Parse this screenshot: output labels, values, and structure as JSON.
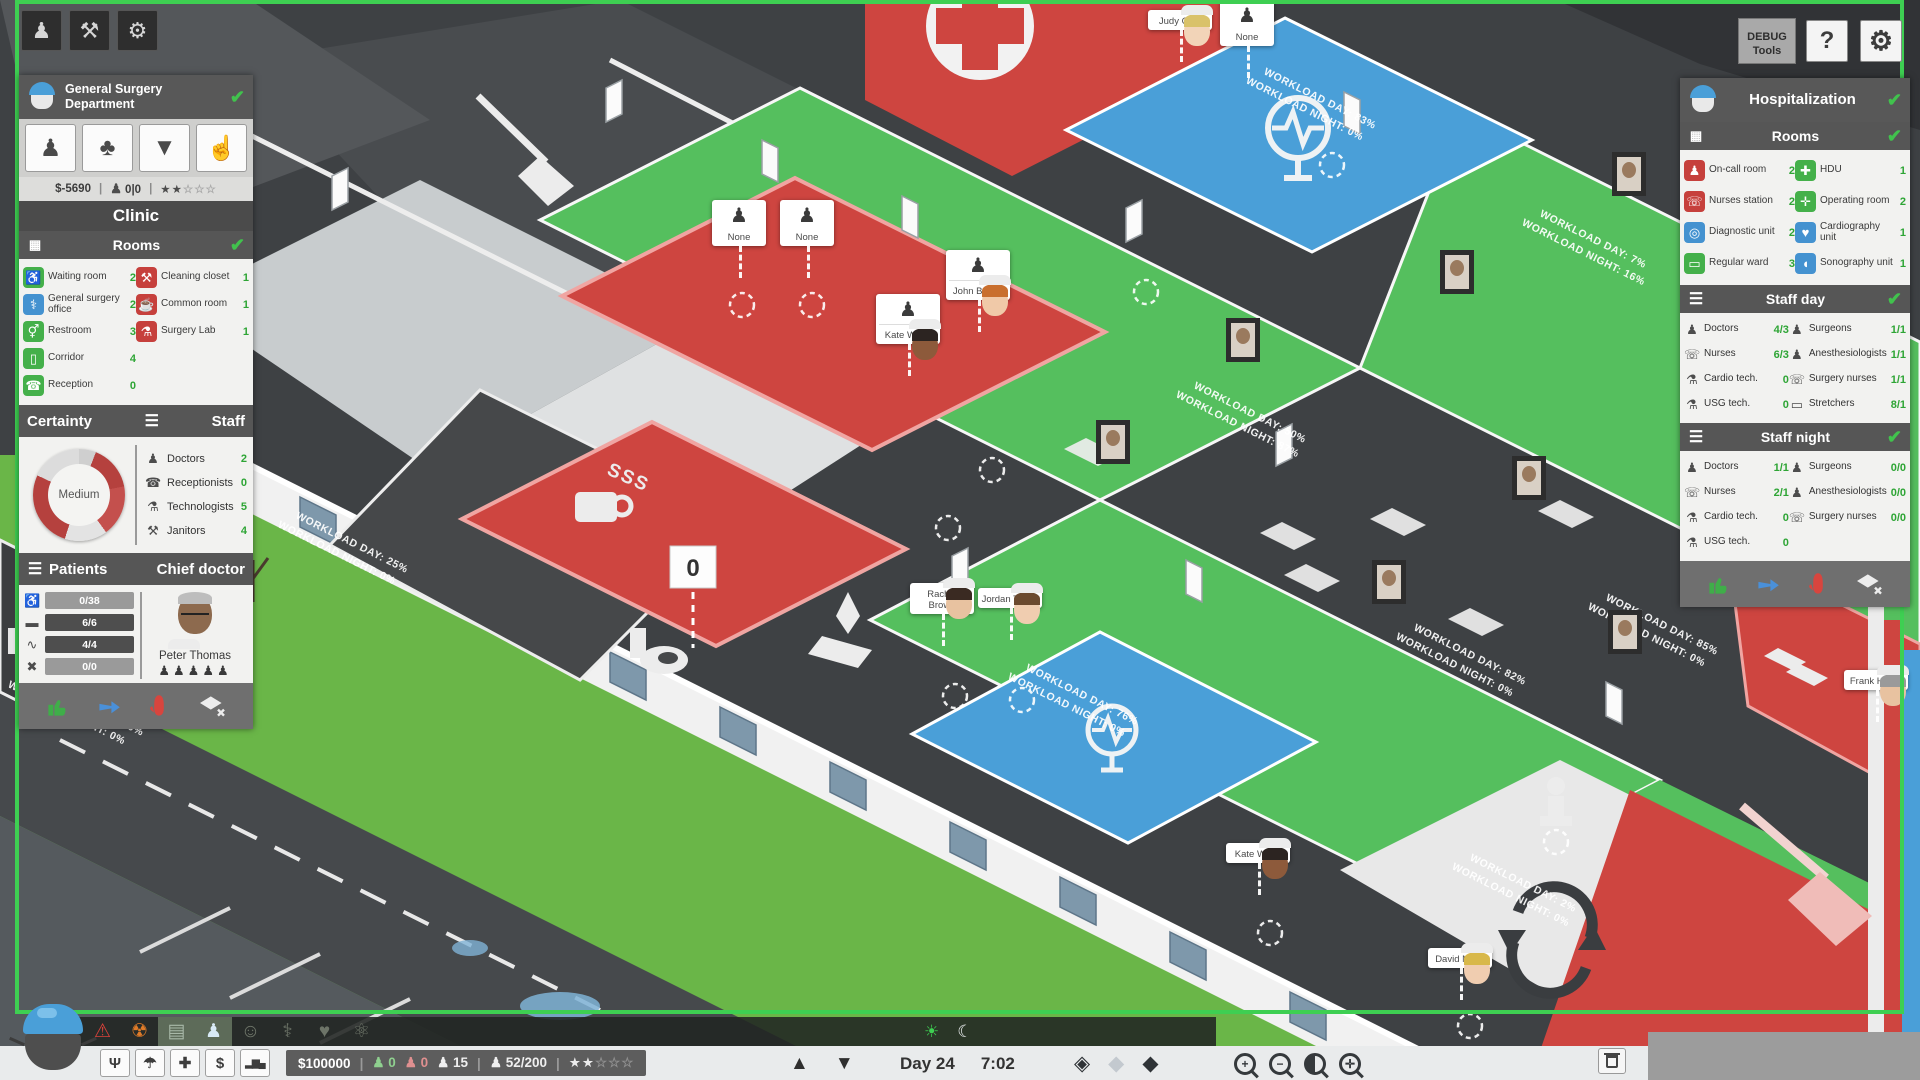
{
  "icon_glyphs": {
    "person": "♟",
    "person-add": "♟",
    "tree": "♣",
    "shirt": "▼",
    "hand": "☝",
    "pickaxe": "⚒",
    "gear": "⚙",
    "list": "☰",
    "rooms": "▦",
    "waiting-room": "♿",
    "cleaning-closet": "⚒",
    "surgery-office": "⚕",
    "common-room": "☕",
    "restroom": "⚥",
    "surgery-lab": "⚗",
    "corridor": "▯",
    "reception": "☎",
    "on-call-room": "♟",
    "hdu": "✚",
    "nurses-station": "☏",
    "operating-room": "✛",
    "diagnostic-unit": "◎",
    "cardiography-unit": "♥",
    "regular-ward": "▭",
    "sonography-unit": "◖",
    "doctor": "♟",
    "receptionist": "☎",
    "technologist": "⚗",
    "janitor": "⚒",
    "nurse": "☏",
    "surgeon": "♟",
    "anesthesiologist": "♟",
    "surgery-nurse": "☏",
    "cardio-tech": "⚗",
    "usg-tech": "⚗",
    "stretcher": "▭",
    "seat": "♿",
    "bed": "▬",
    "pulse": "∿",
    "cross": "✖",
    "emergency": "⚠",
    "radiology": "☢",
    "diagnostics-dept": "▤",
    "surgery-dept": "♟",
    "dept-clinic": "☺",
    "dept-ortho": "⚕",
    "dept-cardio": "♥",
    "dept-neuro": "⚛",
    "network": "Ψ",
    "insurance": "☂",
    "ambulance": "✚",
    "finance": "$",
    "stats": "▂▆▄",
    "floor-up": "▲",
    "floor-down": "▼",
    "sun": "☀",
    "moon": "☾",
    "view-flat": "◈",
    "view-soft": "◆",
    "view-3d": "◆",
    "walker": "♟",
    "patient-bust": "♟",
    "star-filled": "★",
    "star-empty": "☆",
    "check": "✔"
  },
  "top_left_toolbar": {
    "buttons": [
      {
        "name": "staff",
        "icon": "person"
      },
      {
        "name": "build",
        "icon": "pickaxe"
      },
      {
        "name": "management",
        "icon": "gear"
      }
    ]
  },
  "left_panel": {
    "title": "General Surgery Department",
    "tool_buttons": [
      {
        "name": "hire-staff",
        "icon": "person-add"
      },
      {
        "name": "environment",
        "icon": "tree"
      },
      {
        "name": "uniforms",
        "icon": "shirt"
      },
      {
        "name": "policies",
        "icon": "hand"
      }
    ],
    "status": {
      "money": "$-5690",
      "walkers": "0|0",
      "stars_filled": 2,
      "stars_total": 5
    },
    "clinic_title": "Clinic",
    "rooms_title": "Rooms",
    "rooms_col1": [
      {
        "icon": "waiting-room",
        "color": "green",
        "label": "Waiting room",
        "count": "2"
      },
      {
        "icon": "surgery-office",
        "color": "blue",
        "label": "General surgery office",
        "count": "2"
      },
      {
        "icon": "restroom",
        "color": "green",
        "label": "Restroom",
        "count": "3"
      },
      {
        "icon": "corridor",
        "color": "green",
        "label": "Corridor",
        "count": "4"
      },
      {
        "icon": "reception",
        "color": "green",
        "label": "Reception",
        "count": "0"
      }
    ],
    "rooms_col2": [
      {
        "icon": "cleaning-closet",
        "color": "red",
        "label": "Cleaning closet",
        "count": "1"
      },
      {
        "icon": "common-room",
        "color": "red",
        "label": "Common room",
        "count": "1"
      },
      {
        "icon": "surgery-lab",
        "color": "red",
        "label": "Surgery Lab",
        "count": "1"
      }
    ],
    "certainty_title": "Certainty",
    "certainty_value": "Medium",
    "staff_title": "Staff",
    "staff": [
      {
        "icon": "doctor",
        "label": "Doctors",
        "count": "2"
      },
      {
        "icon": "receptionist",
        "label": "Receptionists",
        "count": "0"
      },
      {
        "icon": "technologist",
        "label": "Technologists",
        "count": "5"
      },
      {
        "icon": "janitor",
        "label": "Janitors",
        "count": "4"
      }
    ],
    "patients_title": "Patients",
    "chief_title": "Chief doctor",
    "patient_stats": [
      {
        "icon": "seat",
        "value": "0/38",
        "tone": "light"
      },
      {
        "icon": "bed",
        "value": "6/6",
        "tone": "dark"
      },
      {
        "icon": "pulse",
        "value": "4/4",
        "tone": "dark"
      },
      {
        "icon": "cross",
        "value": "0/0",
        "tone": "light"
      }
    ],
    "chief_name": "Peter Thomas",
    "chief_slots": 5
  },
  "right_panel": {
    "title": "Hospitalization",
    "rooms_title": "Rooms",
    "rooms_col1": [
      {
        "icon": "on-call-room",
        "color": "red",
        "label": "On-call room",
        "count": "2"
      },
      {
        "icon": "nurses-station",
        "color": "red",
        "label": "Nurses station",
        "count": "2"
      },
      {
        "icon": "diagnostic-unit",
        "color": "blue",
        "label": "Diagnostic unit",
        "count": "2"
      },
      {
        "icon": "regular-ward",
        "color": "green",
        "label": "Regular ward",
        "count": "3"
      }
    ],
    "rooms_col2": [
      {
        "icon": "hdu",
        "color": "green",
        "label": "HDU",
        "count": "1"
      },
      {
        "icon": "operating-room",
        "color": "green",
        "label": "Operating room",
        "count": "2"
      },
      {
        "icon": "cardiography-unit",
        "color": "blue",
        "label": "Cardiography unit",
        "count": "1"
      },
      {
        "icon": "sonography-unit",
        "color": "blue",
        "label": "Sonography unit",
        "count": "1"
      }
    ],
    "staff_day_title": "Staff day",
    "staff_day_col1": [
      {
        "icon": "doctor",
        "label": "Doctors",
        "count": "4/3"
      },
      {
        "icon": "nurse",
        "label": "Nurses",
        "count": "6/3"
      },
      {
        "icon": "cardio-tech",
        "label": "Cardio tech.",
        "count": "0"
      },
      {
        "icon": "usg-tech",
        "label": "USG tech.",
        "count": "0"
      }
    ],
    "staff_day_col2": [
      {
        "icon": "surgeon",
        "label": "Surgeons",
        "count": "1/1"
      },
      {
        "icon": "anesthesiologist",
        "label": "Anesthesiologists",
        "count": "1/1"
      },
      {
        "icon": "surgery-nurse",
        "label": "Surgery nurses",
        "count": "1/1"
      },
      {
        "icon": "stretcher",
        "label": "Stretchers",
        "count": "8/1"
      }
    ],
    "staff_night_title": "Staff night",
    "staff_night_col1": [
      {
        "icon": "doctor",
        "label": "Doctors",
        "count": "1/1"
      },
      {
        "icon": "nurse",
        "label": "Nurses",
        "count": "2/1"
      },
      {
        "icon": "cardio-tech",
        "label": "Cardio tech.",
        "count": "0"
      },
      {
        "icon": "usg-tech",
        "label": "USG tech.",
        "count": "0"
      }
    ],
    "staff_night_col2": [
      {
        "icon": "surgeon",
        "label": "Surgeons",
        "count": "0/0"
      },
      {
        "icon": "anesthesiologist",
        "label": "Anesthesiologists",
        "count": "0/0"
      },
      {
        "icon": "surgery-nurse",
        "label": "Surgery nurses",
        "count": "0/0"
      }
    ]
  },
  "top_right": {
    "debug_label": "DEBUG Tools",
    "help_label": "?"
  },
  "bottom_bar": {
    "dept_tabs": [
      {
        "name": "emergency",
        "icon": "emergency",
        "color": "#d8413a",
        "tile": "dark"
      },
      {
        "name": "radiology",
        "icon": "radiology",
        "color": "#e07b28",
        "tile": "dark"
      },
      {
        "name": "diagnostics",
        "icon": "diagnostics-dept",
        "color": "#a8b8a8",
        "tile": "light"
      },
      {
        "name": "surgery",
        "icon": "surgery-dept",
        "color": "#d8eaf6",
        "tile": "light"
      },
      {
        "name": "clinic",
        "icon": "dept-clinic",
        "color": "#6d7468",
        "tile": "dark"
      },
      {
        "name": "orthopedics",
        "icon": "dept-ortho",
        "color": "#6d7468",
        "tile": "dark"
      },
      {
        "name": "cardiology",
        "icon": "dept-cardio",
        "color": "#6d7468",
        "tile": "dark"
      },
      {
        "name": "neurology",
        "icon": "dept-neuro",
        "color": "#6d7468",
        "tile": "dark"
      }
    ],
    "quick_buttons": [
      {
        "name": "departments",
        "icon": "network"
      },
      {
        "name": "insurance",
        "icon": "insurance"
      },
      {
        "name": "ambulance",
        "icon": "ambulance"
      },
      {
        "name": "finance",
        "icon": "finance"
      },
      {
        "name": "statistics",
        "icon": "stats"
      }
    ],
    "status": {
      "money": "$100000",
      "staff_ok": "0",
      "staff_alert": "0",
      "visitors": "15",
      "patients": "52/200",
      "stars_filled": 2,
      "stars_total": 5
    },
    "day_label": "Day 24",
    "time_label": "7:02",
    "zoom_buttons": [
      "+",
      "−",
      "◑",
      "✛"
    ]
  },
  "world": {
    "counter_value": "0",
    "workload_day_prefix": "WORKLOAD DAY:",
    "workload_night_prefix": "WORKLOAD NIGHT:",
    "workload_labels": [
      {
        "x": 300,
        "y": 508,
        "day": "25%",
        "night": "0%"
      },
      {
        "x": 30,
        "y": 668,
        "day": "100%",
        "night": "0%"
      },
      {
        "x": 1268,
        "y": 64,
        "day": "83%",
        "night": "0%"
      },
      {
        "x": 1544,
        "y": 206,
        "day": "7%",
        "night": "16%"
      },
      {
        "x": 1198,
        "y": 378,
        "day": "50%",
        "night": "87%"
      },
      {
        "x": 1030,
        "y": 660,
        "day": "76%",
        "night": "0%"
      },
      {
        "x": 1418,
        "y": 620,
        "day": "82%",
        "night": "0%"
      },
      {
        "x": 1610,
        "y": 590,
        "day": "85%",
        "night": "0%"
      },
      {
        "x": 1474,
        "y": 850,
        "day": "2%",
        "night": "0%"
      }
    ],
    "characters": [
      {
        "name": "None",
        "type": "mini",
        "x": 712,
        "y": 200
      },
      {
        "name": "None",
        "type": "mini",
        "x": 780,
        "y": 200
      },
      {
        "name": "John Brown",
        "type": "full",
        "x": 946,
        "y": 250,
        "hair": "#c96f2e",
        "skin": "#f0c9a8"
      },
      {
        "name": "Kate White",
        "type": "full",
        "x": 876,
        "y": 294,
        "hair": "#2c2421",
        "skin": "#8d5a3b"
      },
      {
        "name": "Judy Cole",
        "type": "portrait",
        "x": 1148,
        "y": 10,
        "hair": "#d9c26a",
        "skin": "#f2d4b8"
      },
      {
        "name": "None",
        "type": "mini",
        "x": 1220,
        "y": 0
      },
      {
        "name": "Rachel Brown",
        "type": "portrait",
        "x": 910,
        "y": 583,
        "hair": "#3a2a22",
        "skin": "#e8c2a0"
      },
      {
        "name": "Jordan Taylor",
        "type": "portrait",
        "x": 978,
        "y": 588,
        "hair": "#6b4a2f",
        "skin": "#f0cdb0"
      },
      {
        "name": "Kate White",
        "type": "portrait",
        "x": 1226,
        "y": 843,
        "hair": "#2c2421",
        "skin": "#8d5a3b"
      },
      {
        "name": "David Miller",
        "type": "portrait",
        "x": 1428,
        "y": 948,
        "hair": "#d8b84a",
        "skin": "#f0cdb0"
      },
      {
        "name": "Frank Harris",
        "type": "portrait",
        "x": 1844,
        "y": 670,
        "hair": "#9a9a9a",
        "skin": "#e8c2a0"
      }
    ],
    "portrait_frames": [
      {
        "x": 1612,
        "y": 152
      },
      {
        "x": 1440,
        "y": 250
      },
      {
        "x": 1226,
        "y": 318
      },
      {
        "x": 1096,
        "y": 420
      },
      {
        "x": 1512,
        "y": 456
      },
      {
        "x": 1372,
        "y": 560
      },
      {
        "x": 1608,
        "y": 610
      }
    ]
  }
}
